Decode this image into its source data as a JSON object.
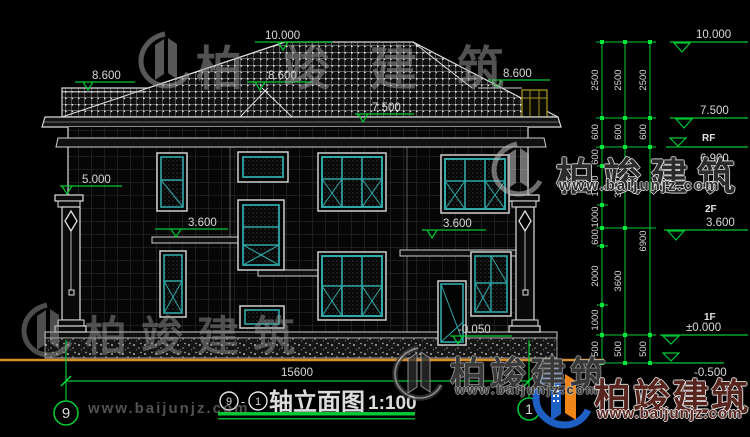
{
  "title": {
    "axis_left_bubble": "9",
    "axis_right_bubble": "1",
    "dash": "-",
    "text": "轴立面图",
    "scale": "1:100"
  },
  "levels": {
    "ridge": "10.000",
    "eave_left": "8.600",
    "eave_mid": "8.600",
    "eave_right": "8.600",
    "roof_low": "7.500",
    "column_top": "5.000",
    "floor2_left": "3.600",
    "floor2_right": "3.600",
    "entry": "-0.050"
  },
  "right_panel": {
    "marks": [
      {
        "label": "10.000"
      },
      {
        "label": "7.500"
      },
      {
        "label": "RF"
      },
      {
        "label": "6.900"
      },
      {
        "label": "2F"
      },
      {
        "label": "3.600"
      },
      {
        "label": "1F"
      },
      {
        "label": "±0.000"
      },
      {
        "label": "-0.500"
      }
    ],
    "chain1": [
      "2500",
      "600",
      "600",
      "1700",
      "1000",
      "600",
      "2000",
      "1000",
      "500"
    ],
    "chain2": [
      "2500",
      "600",
      "3300",
      "3600",
      "500"
    ],
    "chain3": [
      "2500",
      "600",
      "6900",
      "500"
    ]
  },
  "bottom": {
    "total_width": "15600",
    "axis_left": "9",
    "axis_right": "1"
  },
  "watermark": {
    "brand": "柏竣建筑",
    "url": "www.baijunjz.com"
  },
  "colors": {
    "window_teal": "#2fa8a8",
    "dim_green": "#00c832",
    "ground_orange": "#d78f2a",
    "chimney_yellow": "#a3921f",
    "logo_blue": "#1d5fc2",
    "logo_orange": "#f08519",
    "watermark_red": "#4a120c"
  }
}
